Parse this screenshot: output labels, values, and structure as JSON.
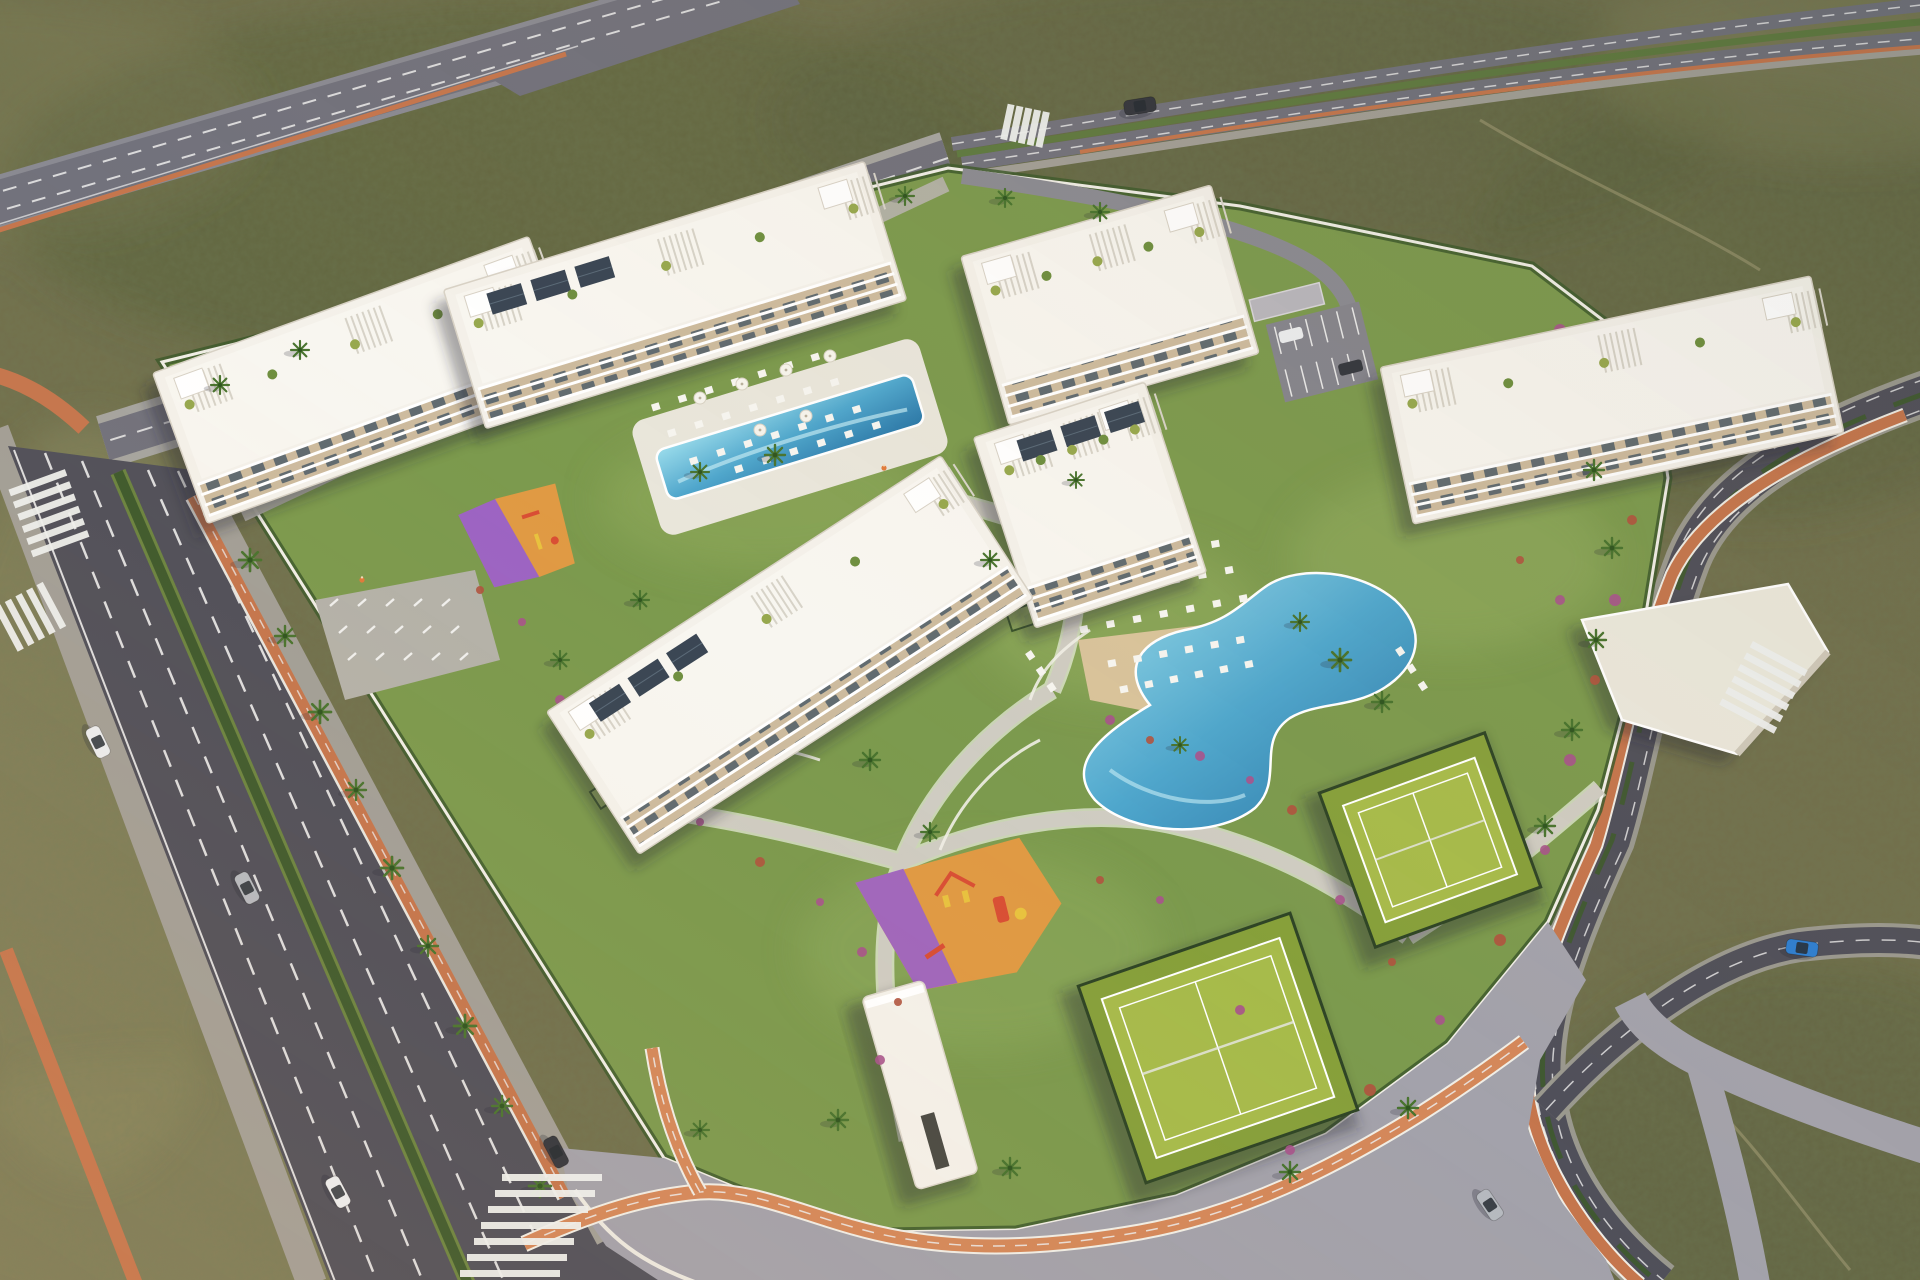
{
  "scene": {
    "type": "aerial-architectural-render",
    "subject": "residential-resort-complex",
    "environment": "semi-arid-scrubland",
    "lighting": "golden-hour"
  },
  "palette": {
    "terrain": "#716f4c",
    "terrain_dark": "#59603c",
    "terrain_light": "#8b8961",
    "sand": "#9a9370",
    "speckle": "#2f3a22",
    "asphalt": "#50505a",
    "asphalt_dark": "#45454e",
    "highway": "#72727c",
    "road_line": "#ececec",
    "paver": "#b4b2a9",
    "paver_blue": "#a3a2ab",
    "paver_light": "#cfccc2",
    "sidewalk": "#a29f97",
    "bike": "#c5764d",
    "bike_bright": "#d4885a",
    "wall": "#f0eee6",
    "hedge": "#3e5a2d",
    "median_green": "#5f7a40",
    "grass": "#7c9a4e",
    "grass_light": "#94ae5f",
    "building": "#f4f1ea",
    "building_trim": "#d8d2c6",
    "balcony_tan": "#cdbb9e",
    "glass": "#55626b",
    "roof": "#f8f6f0",
    "pergola": "#d7d3c8",
    "solar": "#3a4654",
    "solar_grid": "#5a6a78",
    "deck": "#e9e6db",
    "deck_tan": "#d9c49b",
    "pool_light": "#8fd2e6",
    "pool_deep": "#2e7cab",
    "court": "#a7bb4b",
    "court_dark": "#87a03b",
    "fence": "#2f4526",
    "pg_orange": "#e09a44",
    "pg_purple": "#9d64c3",
    "equip_red": "#d94f35",
    "equip_yellow": "#e8c23f",
    "shrub": "#a8548c",
    "shrub_red": "#b0543f",
    "palm": "#49742f",
    "palm_dark": "#2f5520",
    "shadow": "rgba(38,40,52,0.38)",
    "car_white": "#eceef0",
    "car_silver": "#b6bac0",
    "car_dark": "#34373e",
    "car_blue": "#2f7fd0"
  },
  "inventory": {
    "apartment_buildings": 6,
    "swimming_pools": 2,
    "sports_courts": 2,
    "playgrounds": 2,
    "entrance_gate": 1,
    "community_pavilion": 1,
    "parking_lot": 1,
    "cars": 7,
    "bike_lane_color_name": "terracotta-orange"
  },
  "cars": [
    {
      "name": "white-car-avenue",
      "x": 98,
      "y": 742,
      "rot": 64,
      "color": "car_white"
    },
    {
      "name": "silver-van-avenue",
      "x": 247,
      "y": 888,
      "rot": 63,
      "color": "car_silver"
    },
    {
      "name": "white-car-avenue-2",
      "x": 338,
      "y": 1192,
      "rot": 62,
      "color": "car_white"
    },
    {
      "name": "dark-car-avenue",
      "x": 556,
      "y": 1152,
      "rot": 62,
      "color": "car_dark"
    },
    {
      "name": "silver-car-east-road",
      "x": 1490,
      "y": 1205,
      "rot": 56,
      "color": "car_silver"
    },
    {
      "name": "blue-car-loop-road",
      "x": 1802,
      "y": 948,
      "rot": 8,
      "color": "car_blue"
    },
    {
      "name": "dark-car-top-road",
      "x": 1140,
      "y": 106,
      "rot": -9,
      "color": "car_dark"
    }
  ],
  "palms": [
    [
      250,
      560,
      1.1
    ],
    [
      285,
      636,
      1.0
    ],
    [
      320,
      712,
      1.1
    ],
    [
      356,
      790,
      1.0
    ],
    [
      392,
      868,
      1.1
    ],
    [
      428,
      946,
      1.0
    ],
    [
      465,
      1026,
      1.1
    ],
    [
      502,
      1106,
      1.0
    ],
    [
      540,
      1186,
      1.1
    ],
    [
      220,
      385,
      0.9
    ],
    [
      300,
      350,
      0.9
    ],
    [
      905,
      196,
      0.9
    ],
    [
      1005,
      198,
      0.9
    ],
    [
      1100,
      212,
      0.9
    ],
    [
      1594,
      470,
      1.0
    ],
    [
      1612,
      548,
      1.0
    ],
    [
      1596,
      640,
      1.0
    ],
    [
      1572,
      730,
      1.0
    ],
    [
      1545,
      826,
      1.0
    ],
    [
      775,
      455,
      1.0
    ],
    [
      700,
      472,
      0.9
    ],
    [
      1340,
      660,
      1.1
    ],
    [
      1382,
      702,
      1.0
    ],
    [
      1300,
      622,
      0.9
    ],
    [
      870,
      760,
      1.0
    ],
    [
      930,
      832,
      0.9
    ],
    [
      990,
      560,
      0.9
    ],
    [
      640,
      600,
      0.9
    ],
    [
      560,
      660,
      0.9
    ],
    [
      838,
      1120,
      1.0
    ],
    [
      1010,
      1168,
      1.0
    ],
    [
      700,
      1130,
      0.9
    ],
    [
      1290,
      1172,
      1.0
    ],
    [
      1408,
      1108,
      1.0
    ],
    [
      1076,
      480,
      0.8
    ],
    [
      1180,
      745,
      0.8
    ]
  ],
  "lounger_rows": [
    [
      652,
      408,
      838,
      350,
      7
    ],
    [
      668,
      434,
      858,
      375,
      7
    ],
    [
      690,
      462,
      880,
      402,
      7
    ],
    [
      735,
      470,
      900,
      418,
      6
    ],
    [
      1052,
      572,
      1238,
      540,
      7
    ],
    [
      1064,
      600,
      1252,
      566,
      7
    ],
    [
      1080,
      630,
      1266,
      594,
      7
    ],
    [
      1108,
      664,
      1262,
      636,
      6
    ],
    [
      1120,
      690,
      1270,
      660,
      6
    ],
    [
      1398,
      648,
      1432,
      700,
      3
    ],
    [
      1028,
      652,
      1060,
      700,
      3
    ]
  ],
  "parasols": [
    [
      700,
      398
    ],
    [
      742,
      384
    ],
    [
      786,
      370
    ],
    [
      830,
      356
    ],
    [
      760,
      430
    ],
    [
      806,
      416
    ]
  ],
  "shrubs": [
    [
      1560,
      330,
      6,
      "shrub"
    ],
    [
      1600,
      380,
      5,
      "shrub_red"
    ],
    [
      1622,
      440,
      6,
      "shrub"
    ],
    [
      1632,
      520,
      5,
      "shrub_red"
    ],
    [
      1615,
      600,
      6,
      "shrub"
    ],
    [
      1595,
      680,
      5,
      "shrub_red"
    ],
    [
      1570,
      760,
      6,
      "shrub"
    ],
    [
      1545,
      850,
      5,
      "shrub"
    ],
    [
      1500,
      940,
      6,
      "shrub_red"
    ],
    [
      1440,
      1020,
      5,
      "shrub"
    ],
    [
      1370,
      1090,
      6,
      "shrub_red"
    ],
    [
      1290,
      1150,
      5,
      "shrub"
    ],
    [
      1110,
      720,
      5,
      "shrub"
    ],
    [
      1150,
      740,
      4,
      "shrub_red"
    ],
    [
      1200,
      756,
      5,
      "shrub"
    ],
    [
      1250,
      780,
      4,
      "shrub"
    ],
    [
      1292,
      810,
      5,
      "shrub_red"
    ],
    [
      560,
      700,
      5,
      "shrub"
    ],
    [
      600,
      742,
      4,
      "shrub_red"
    ],
    [
      644,
      782,
      5,
      "shrub"
    ],
    [
      700,
      822,
      4,
      "shrub"
    ],
    [
      760,
      862,
      5,
      "shrub_red"
    ],
    [
      820,
      902,
      4,
      "shrub"
    ],
    [
      862,
      952,
      5,
      "shrub"
    ],
    [
      898,
      1002,
      4,
      "shrub_red"
    ],
    [
      880,
      1060,
      5,
      "shrub"
    ],
    [
      480,
      590,
      4,
      "shrub_red"
    ],
    [
      522,
      622,
      4,
      "shrub"
    ],
    [
      1340,
      900,
      5,
      "shrub"
    ],
    [
      1392,
      962,
      4,
      "shrub_red"
    ],
    [
      1240,
      1010,
      5,
      "shrub"
    ],
    [
      1160,
      900,
      4,
      "shrub"
    ],
    [
      1100,
      880,
      4,
      "shrub_red"
    ],
    [
      1560,
      600,
      5,
      "shrub"
    ],
    [
      1520,
      560,
      4,
      "shrub_red"
    ]
  ],
  "garden_rows": [
    {
      "x": 590,
      "y": 792,
      "rot": -33,
      "count": 9,
      "pitch": 42
    },
    {
      "x": 468,
      "y": 398,
      "rot": -17,
      "count": 9,
      "pitch": 46
    },
    {
      "x": 198,
      "y": 482,
      "rot": -20,
      "count": 8,
      "pitch": 44
    },
    {
      "x": 1408,
      "y": 472,
      "rot": -12,
      "count": 9,
      "pitch": 46
    },
    {
      "x": 996,
      "y": 368,
      "rot": -16,
      "count": 6,
      "pitch": 44
    },
    {
      "x": 1006,
      "y": 612,
      "rot": -18,
      "count": 4,
      "pitch": 44
    }
  ],
  "crosswalks": [
    {
      "x": 552,
      "y": 1230,
      "rot": 0,
      "n": 7,
      "len": 100,
      "step": 16,
      "stagger": -7
    },
    {
      "x": 50,
      "y": 516,
      "rot": -20,
      "n": 6,
      "len": 60,
      "step": 13,
      "stagger": 0
    },
    {
      "x": 28,
      "y": 618,
      "rot": 62,
      "n": 5,
      "len": 50,
      "step": 12,
      "stagger": 0
    },
    {
      "x": 1762,
      "y": 690,
      "rot": 28,
      "n": 6,
      "len": 62,
      "step": 13,
      "stagger": 0
    },
    {
      "x": 1026,
      "y": 126,
      "rot": -78,
      "n": 5,
      "len": 36,
      "step": 9,
      "stagger": 0
    }
  ],
  "bike_racks": {
    "x": 330,
    "y": 606,
    "rows": 3,
    "cols": 5,
    "dx": 28,
    "dy": 27,
    "rowShift": 9
  },
  "people": [
    [
      362,
      580
    ],
    [
      884,
      468
    ]
  ]
}
